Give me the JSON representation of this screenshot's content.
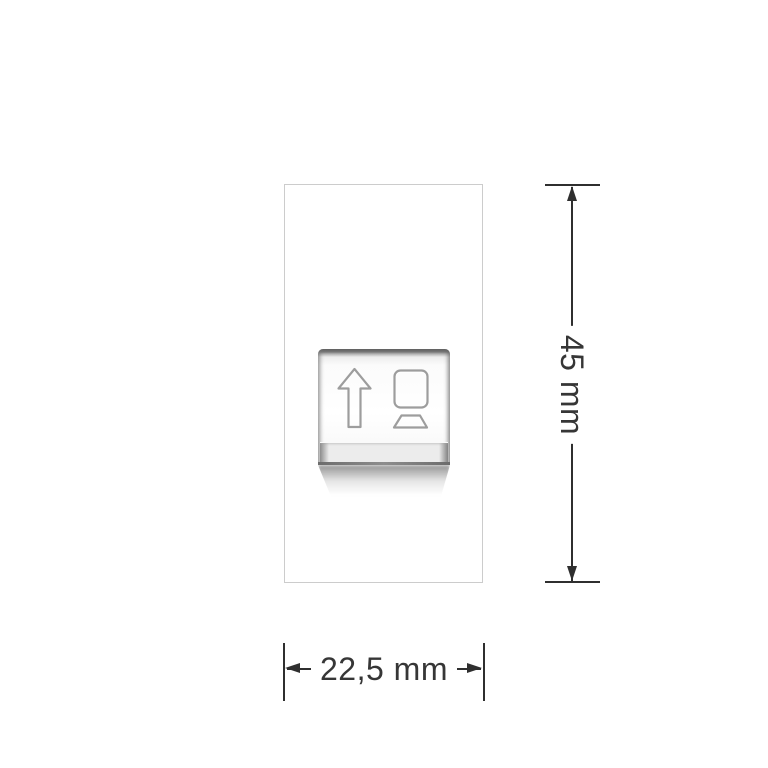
{
  "product_diagram": {
    "description": "Dimensional drawing of a single socket module faceplate with data jack",
    "module": {
      "icons": [
        {
          "name": "up-arrow-icon"
        },
        {
          "name": "computer-icon"
        }
      ]
    },
    "height_dimension": {
      "label": "45 mm"
    },
    "width_dimension": {
      "label": "22,5 mm"
    },
    "colors": {
      "background": "#ffffff",
      "plate_border": "#cccccc",
      "insert_dark_edge": "#5e5e5e",
      "shutter_fill": "#ececec",
      "dimension_lines": "#2f2f2f",
      "dimension_text": "#363636",
      "icon_stroke": "#9d9d9d"
    }
  }
}
